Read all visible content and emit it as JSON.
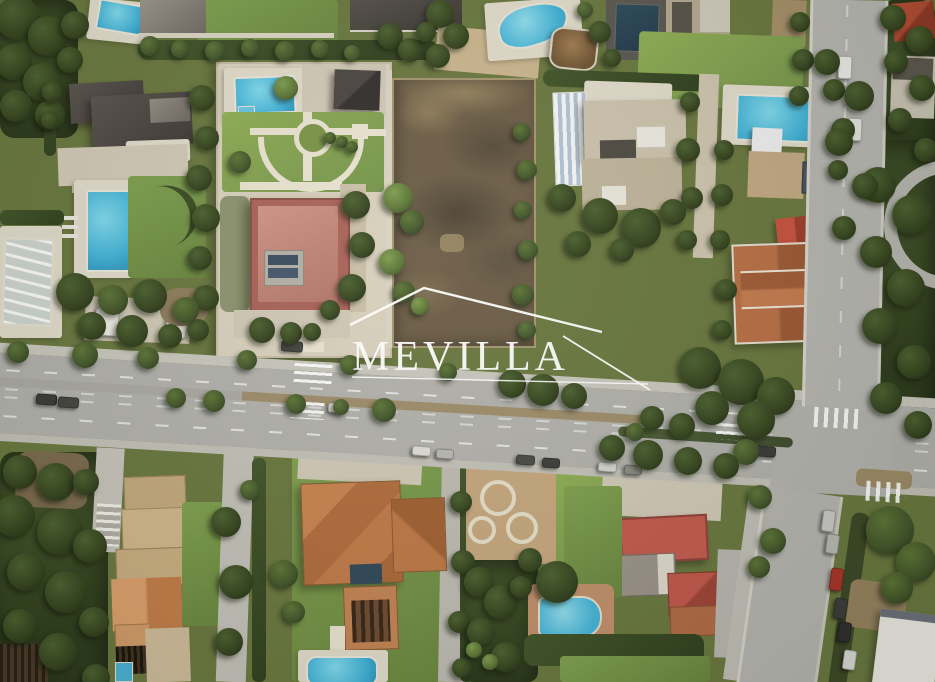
{
  "image_type": "aerial-satellite-photograph",
  "watermark": {
    "text": "MEVILLA",
    "symbol": "roof-outline-with-underline",
    "color": "#ffffff"
  },
  "scene": {
    "description": "Aerial satellite view of a Mediterranean residential villa neighbourhood split by a tree-lined avenue; a large vacant brown plot sits in the top centre under the MEVILLA watermark.",
    "features": [
      "vacant brown land plot (subject of listing) walled on all sides, top centre",
      "walled estate with formal fan-shaped garden, circular fountain hub, rectangular pool and red flat-roofed villa",
      "dark-roofed villa with vertical rectangular pool and lawn, top left",
      "covered pool on the left edge and two white vans parked nearby",
      "beige flat-roofed villa with white pergola and skylights, right of the plot",
      "kidney-shaped pool, brown gazebo and dark lap pool along the top edge",
      "far-right estate with bright blue pool, white canopy, solar panels, bright red gable and terracotta roof complex",
      "tree-lined avenue crossing the full width with median trees, dashed lane lines, zebra crossings and parked cars",
      "vertical side road entering from the top right corner with parked cars and palm canopy",
      "narrow street descending to the bottom right lined with parked cars (one red)",
      "terracotta-roofed villa with small tower, dark courtyard patch and pool, bottom centre",
      "stepped tan-roofed house with orange gable, slatted pergola and tiny pool, bottom left",
      "villa with bright red flat roof, red hip roof and round-ended pool, bottom right of the avenue",
      "garden of circular paved planters left of the bottom-right villa",
      "dense Mediterranean pines, hedges and palm trees throughout"
    ],
    "counts": {
      "swimming_pools_visible": 10,
      "zebra_crossings": 5
    },
    "palette": {
      "asphalt": "#b1b0ab",
      "sidewalk": "#c8c6bd",
      "lane_marking": "#ffffff",
      "dirt_plot": "#6b5c46",
      "dirt_light": "#92805f",
      "lawn": "#7fa04f",
      "lawn_bright": "#8fae55",
      "tree_dark": "#35441f",
      "pool_water": "#43b2d8",
      "dark_lap_pool": "#2c4a5c",
      "paving": "#d0c8b6",
      "roof_dark_gray": "#46413d",
      "roof_red_flat": "#c08176",
      "roof_terracotta": "#b5713f",
      "roof_bright_red": "#c25a4e",
      "roof_tan": "#c7bda6",
      "watermark": "#ffffff"
    }
  }
}
